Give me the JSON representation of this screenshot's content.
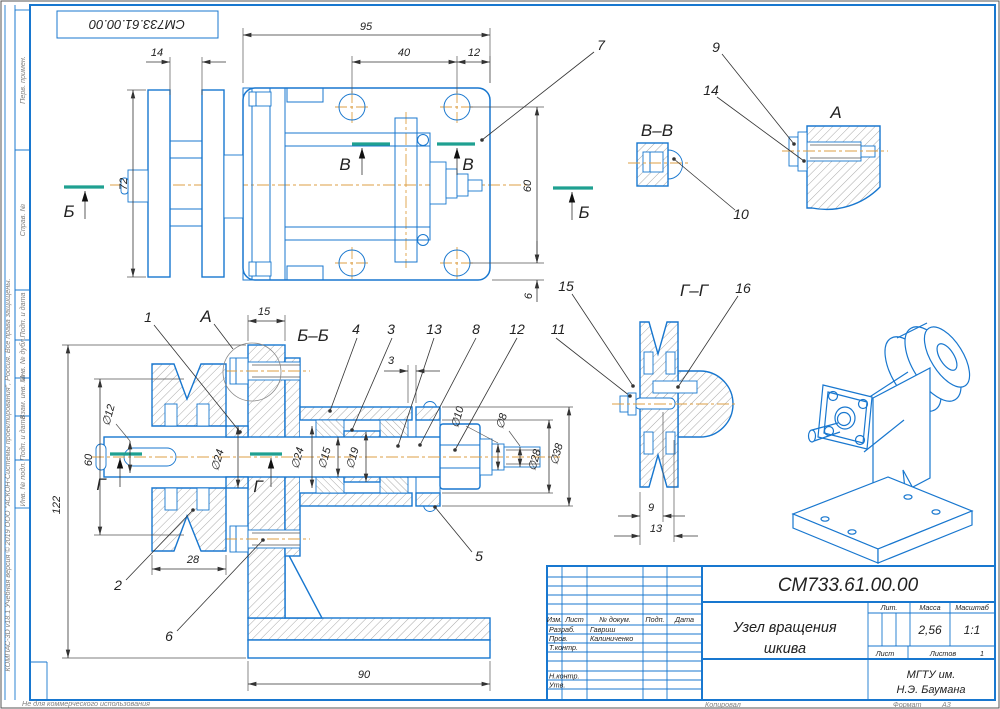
{
  "sheet": {
    "corner_stamp": "СМ733.61.00.00",
    "watermark": "КОМПАС-3D v18.1 Учебная версия © 2019 ООО \"АСКОН-Системы проектирования\", Россия. Все права защищены.",
    "non_commercial": "Не для коммерческого использования",
    "side_labels": {
      "perv": "Перв. примен.",
      "sprav": "Справ. №",
      "podp1": "Подп. и дата",
      "inv_dubl": "Инв. № дубл.",
      "vzam": "Взам. инв. №",
      "podp2": "Подп. и дата",
      "inv_podl": "Инв. № подл."
    }
  },
  "title_block": {
    "doc_number": "СМ733.61.00.00",
    "title_line1": "Узел вращения",
    "title_line2": "шкива",
    "header_cols": {
      "izm": "Изм.",
      "list": "Лист",
      "doc": "№ докум.",
      "podp": "Подп.",
      "data": "Дата"
    },
    "roles": {
      "razrab": "Разраб.",
      "prov": "Пров.",
      "tkontr": "Т.контр.",
      "nkontr": "Н.контр.",
      "utv": "Утв."
    },
    "names": {
      "razrab": "Гавриш",
      "prov": "Калиниченко"
    },
    "lit": "Лит.",
    "massa": "Масса",
    "masshtab": "Масштаб",
    "massa_value": "2,56",
    "masshtab_value": "1:1",
    "list": "Лист",
    "listov": "Листов",
    "listov_value": "1",
    "org_line1": "МГТУ им.",
    "org_line2": "Н.Э. Баумана",
    "kopiroval": "Копировал",
    "format": "Формат",
    "format_value": "А3"
  },
  "labels": {
    "sec_bb": "Б–Б",
    "sec_vv": "В–В",
    "sec_gg": "Г–Г",
    "view_a": "А",
    "detail_a": "А",
    "arrow_b": "Б",
    "arrow_v": "В",
    "arrow_g": "Г"
  },
  "callouts": {
    "c1": "1",
    "c2": "2",
    "c3": "3",
    "c4": "4",
    "c5": "5",
    "c6": "6",
    "c7": "7",
    "c8": "8",
    "c9": "9",
    "c10": "10",
    "c11": "11",
    "c12": "12",
    "c13": "13",
    "c14": "14",
    "c15": "15",
    "c16": "16"
  },
  "dims": {
    "top": {
      "w95": "95",
      "w40": "40",
      "w12": "12",
      "w14": "14",
      "h72": "72",
      "h60": "60",
      "h6": "6"
    },
    "front": {
      "d12": "∅12",
      "h60": "60",
      "h122": "122",
      "w28": "28",
      "w15": "15",
      "w3": "3",
      "d24a": "∅24",
      "d24b": "∅24",
      "d15": "∅15",
      "d19": "∅19",
      "d10": "∅10",
      "d8": "∅8",
      "d28": "∅28",
      "d38": "∅38",
      "w90": "90"
    },
    "gg": {
      "w9": "9",
      "w13": "13"
    }
  }
}
